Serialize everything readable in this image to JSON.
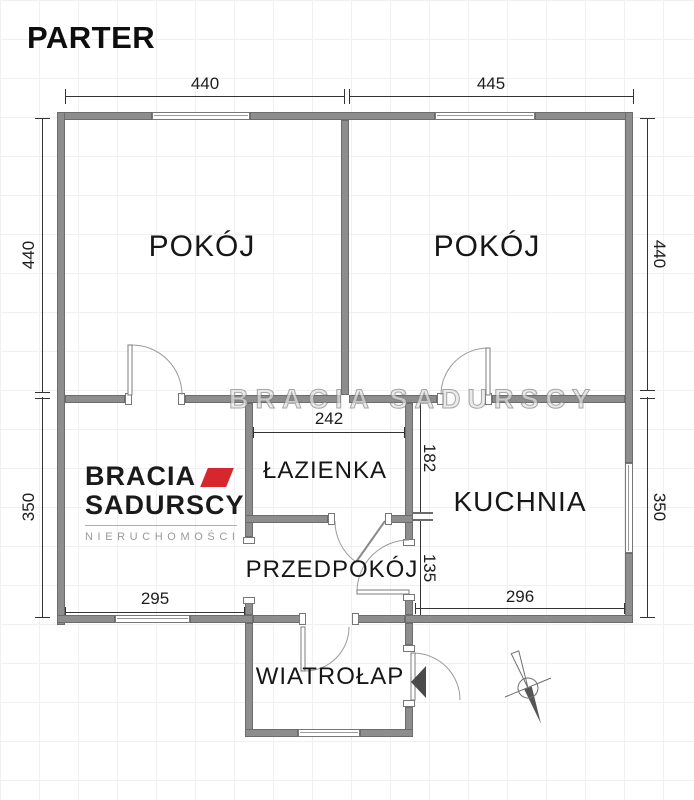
{
  "title": "PARTER",
  "watermark": "BRACIA SADURSCY",
  "rooms": {
    "room_left": "POKÓJ",
    "room_right": "POKÓJ",
    "bathroom": "ŁAZIENKA",
    "kitchen": "KUCHNIA",
    "hallway": "PRZEDPOKÓJ",
    "vestibule": "WIATROŁAP"
  },
  "dimensions": {
    "top_left_width": "440",
    "top_right_width": "445",
    "left_upper_height": "440",
    "left_lower_height": "350",
    "right_upper_height": "440",
    "right_lower_height": "350",
    "bathroom_width": "242",
    "bathroom_side_height": "182",
    "hallway_side_height": "135",
    "bottom_left_width": "295",
    "kitchen_width": "296"
  },
  "logo": {
    "line1": "BRACIA",
    "line2": "SADURSCY",
    "line3": "NIERUCHOMOŚCI"
  },
  "colors": {
    "wall": "#8d8d8d",
    "wall_border": "#6c6c6c",
    "dimension": "#333333",
    "accent": "#d6272e",
    "logo_gray": "#9a9a9a"
  }
}
